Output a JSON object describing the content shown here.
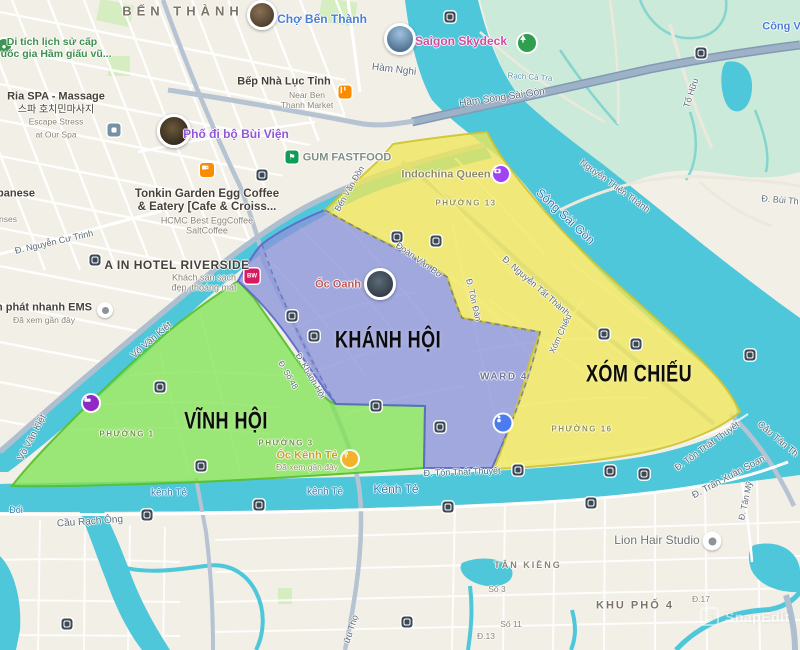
{
  "zones": {
    "vinh_hoi": "VĨNH HỘI",
    "khanh_hoi": "KHÁNH HỘI",
    "xom_chieu": "XÓM CHIẾU"
  },
  "areas": {
    "ben_thanh": "BẾN THÀNH",
    "ward_4": "WARD 4",
    "phuong_1": "PHƯỜNG 1",
    "phuong_3": "PHƯỜNG 3",
    "phuong_13": "PHƯỜNG 13",
    "phuong_16": "PHƯỜNG 16",
    "tan_kieng": "TÂN KIỀNG",
    "khu_pho_4": "KHU PHỐ 4"
  },
  "pois": {
    "cho_ben_thanh": {
      "name": "Chợ Bến Thành"
    },
    "saigon_skydeck": {
      "name": "Saigon Skydeck"
    },
    "cong_vien": {
      "name": "Công Viê"
    },
    "heritage": {
      "line1": "Di tích lịch sử cấp",
      "line2": "Quốc gia Hầm giấu vũ..."
    },
    "ria_spa": {
      "name": "Ria SPA - Massage",
      "korean": "스파 호치민마사지",
      "sub1": "Escape Stress",
      "sub2": "at Our Spa"
    },
    "japanese_partial": "panese",
    "nses_partial": "nses",
    "bep_nha_luc_tinh": {
      "name": "Bếp Nhà Lục Tỉnh",
      "sub1": "Near Ben",
      "sub2": "Thanh Market"
    },
    "pho_di_bo_bui_vien": {
      "name": "Phố đi bộ Bùi Viện"
    },
    "gum_fastfood": {
      "name": "GUM FASTFOOD"
    },
    "tonkin": {
      "line1": "Tonkin Garden Egg Coffee",
      "line2": "& Eatery [Cafe & Croiss...",
      "sub1": "HCMC Best EggCoffee",
      "sub2": "SaltCoffee"
    },
    "a_in_hotel": {
      "name": "A IN HOTEL RIVERSIDE",
      "sub1": "Khách sạn sạch",
      "sub2": "đẹp, thoáng mát"
    },
    "ems": {
      "name": "n phát nhanh EMS",
      "sub": "Đã xem gần đây"
    },
    "indochina_queen": {
      "name": "Indochina Queen"
    },
    "oc_oanh": {
      "name": "Ốc Oanh"
    },
    "oc_kenh_te": {
      "name": "Ốc Kênh Tẻ",
      "sub": "Đã xem gần đây"
    },
    "lion_hair": {
      "name": "Lion Hair Studio"
    },
    "bw_badge": "BW"
  },
  "roads": {
    "ham_nghi": "Hàm Nghi",
    "ham_song_sai_gon": "Hầm Sông Sài Gòn",
    "to_huu": "Tố Hữu",
    "nguyen_thien_thanh": "Nguyễn Thiện Thành",
    "bui_th": "Đ. Bùi Th",
    "nguyen_cu_trinh": "Đ. Nguyễn Cư Trinh",
    "vo_van_kiet": "Võ Văn Kiệt",
    "ben_van_don": "Bến Văn Đồn",
    "doan_van_bo": "Đoàn Văn Bơ",
    "ton_dan": "Đ. Tôn Đản",
    "nguyen_tat_thanh": "Đ. Nguyễn Tất Thành",
    "xom_chieu_st": "Xóm Chiếu",
    "khanh_hoi_st": "Đ. Khánh Hội",
    "so_48": "Đ. Số 48",
    "ton_that_thuyet": "Đ. Tôn Thất Thuyết",
    "tran_xuan_soan": "Đ. Trần Xuân Soạn",
    "cau_tan_thuan": "Cầu Tân Th",
    "tan_my": "Đ. Tân Mỹ",
    "cau_rach_ong": "Cầu Rạch Ông",
    "huu_tho": "ữu Thọ",
    "so_3": "Số 3",
    "so_11": "Số 11",
    "d13": "Đ.13",
    "d17": "Đ.17"
  },
  "water": {
    "song_sai_gon": "Sông Sài Gòn",
    "kenh_te": "kênh Tẻ",
    "kenh_te_cap": "Kênh Tẻ",
    "rach_ca_tra": "Rạch Cà Tra",
    "doi": "Đổi"
  },
  "watermark": "SnapEdit",
  "colors": {
    "zone_green": "#82e356",
    "zone_blue": "#8a94da",
    "zone_yellow": "#efe75a",
    "water": "#4ec7da",
    "mint": "#cbead9"
  }
}
